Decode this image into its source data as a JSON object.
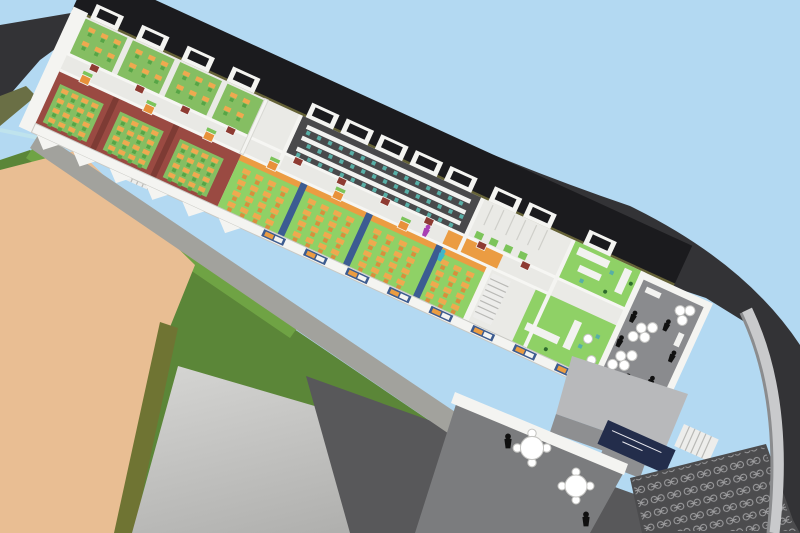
{
  "scene": {
    "type": "3d-architectural-rendering",
    "subject": "aerial cutaway view of a school building floor plan with furnished rooms and surrounding site",
    "regions": [
      {
        "id": "sky",
        "color_key": "sky"
      },
      {
        "id": "hillside-terrain",
        "color_key": "terrain"
      },
      {
        "id": "building-roof-band",
        "color_key": "roof_black"
      },
      {
        "id": "red-floor-classrooms",
        "color_key": "classroom_red",
        "desk_color_key": "desk_orange",
        "chair_color_key": "chair_green",
        "rug_color_key": "rug_green",
        "count": 3
      },
      {
        "id": "green-floor-classrooms",
        "color_key": "classroom_green",
        "desk_color_key": "desk_orange",
        "partition_color_key": "partition_blue",
        "count": 4
      },
      {
        "id": "computer-lab",
        "color_key": "lab_floor",
        "bench_color_key": "bench_white",
        "seat_color_key": "seat_teal",
        "bench_rows": 3
      },
      {
        "id": "north-group-rooms",
        "color_key": "rug_green",
        "count": 4
      },
      {
        "id": "corridor",
        "color_key": "corridor_floor",
        "accent_color_key": "accent_orange"
      },
      {
        "id": "toilet-block",
        "color_key": "floor_white",
        "door_color_key": "transom_green"
      },
      {
        "id": "cafeteria",
        "color_key": "classroom_green",
        "counter_color_key": "bench_white"
      },
      {
        "id": "roof-terrace",
        "color_key": "terrace_gray",
        "stool_color_key": "stool_white"
      },
      {
        "id": "entrance-canopy",
        "color_key": "entry_roof_light"
      },
      {
        "id": "lower-courtyard",
        "color_key": "courtyard_gray"
      },
      {
        "id": "bike-parking",
        "color_key": "bike_ground",
        "glyph_color_key": "bike_glyph"
      },
      {
        "id": "entrance-sign",
        "color_key": "sign_navy"
      },
      {
        "id": "sports-field",
        "color_key": "field_tan"
      },
      {
        "id": "grass-slope",
        "color_key": "grass"
      },
      {
        "id": "paved-yard",
        "color_key": "paving"
      },
      {
        "id": "people-silhouettes",
        "color_key": "person_black"
      }
    ]
  },
  "palette": {
    "sky": "#b3d9f2",
    "terrain": "#333336",
    "roof_black": "#1b1b1e",
    "roof_edge_olive": "#6e6a3a",
    "olive_bank": "#6a6f45",
    "water_edge": "#bfe3ed",
    "grass": "#5b8638",
    "grass_light": "#6fa344",
    "field_tan": "#e9be93",
    "hedge": "#6f7433",
    "paving": "#cccccc",
    "paving_dark": "#b0b0ae",
    "path_gray": "#a2a29d",
    "plinth_band": "#58585a",
    "courtyard_gray": "#7b7c7e",
    "bike_ground": "#4c4c4e",
    "bike_glyph": "#a0a0a2",
    "retaining_wall": "#c9cacc",
    "retaining_wall_dark": "#8b8c8e",
    "wall_white": "#f4f4f1",
    "floor_white": "#eaeae6",
    "corridor_floor": "#e9e9e5",
    "classroom_red": "#9a4a42",
    "classroom_red_wall": "#7e3b34",
    "rug_green": "#85be62",
    "classroom_green": "#8fd166",
    "partition_blue": "#3c5c92",
    "accent_orange": "#eb9c42",
    "desk_orange": "#efa94f",
    "chair_green": "#57a546",
    "chair_orange": "#d98e3c",
    "lab_floor": "#49494b",
    "bench_white": "#f2f2f0",
    "seat_teal": "#58afa7",
    "door_red": "#8e3b32",
    "door_orange": "#e8913a",
    "transom_green": "#7cc45a",
    "window_blue": "#3d5c90",
    "sign_navy": "#232d4b",
    "terrace_gray": "#8a8b8e",
    "entry_roof_light": "#b8b9bb",
    "entry_roof_dark": "#8e8f91",
    "stool_white": "#ffffff",
    "stair_white": "#ededeb",
    "person_black": "#101010",
    "person_purple": "#a93fb3",
    "person_cyan": "#3fb6c9",
    "plant_green": "#2e6b2e"
  }
}
